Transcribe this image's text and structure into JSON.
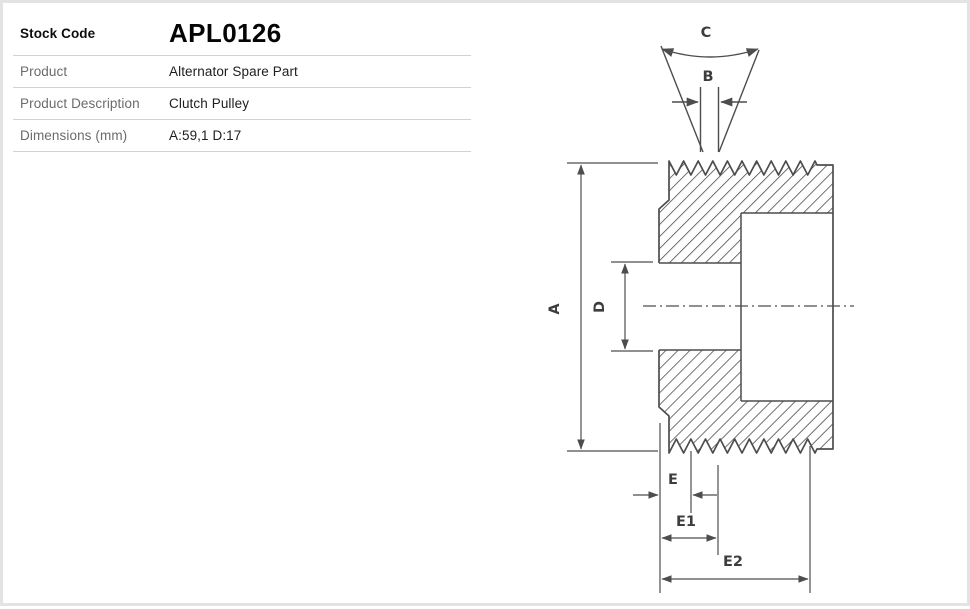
{
  "table": {
    "rows": [
      {
        "label": "Stock Code",
        "value": "APL0126"
      },
      {
        "label": "Product",
        "value": "Alternator Spare Part"
      },
      {
        "label": "Product Description",
        "value": "Clutch Pulley"
      },
      {
        "label": "Dimensions (mm)",
        "value": "A:59,1 D:17"
      }
    ]
  },
  "diagram": {
    "description": "Clutch pulley cross-section technical drawing with dimension callouts",
    "dim_labels": {
      "groove_angle": "C",
      "groove_width": "B",
      "outer_diameter": "A",
      "bore_diameter": "D",
      "offset_e": "E",
      "offset_e1": "E1",
      "offset_e2": "E2"
    }
  },
  "colors": {
    "page_background": "#ffffff",
    "page_frame": "#e3e3e3",
    "table_divider": "#d2d2d2",
    "label_gray": "#6b6b6b",
    "value_dark": "#1d1d1d",
    "drawing_line": "#4d4d4d"
  }
}
